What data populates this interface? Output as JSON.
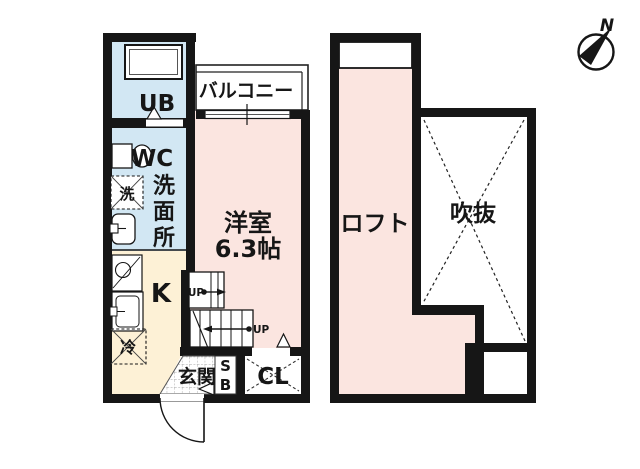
{
  "title": "apartment-floor-plan",
  "colors": {
    "wall": "#161616",
    "room_pink": "#fbe5e0",
    "room_blue": "#d2e7f3",
    "room_cream": "#fdf1d6",
    "white": "#ffffff",
    "thin_line": "#2a2a2a"
  },
  "compass": {
    "north": "N"
  },
  "floor1": {
    "balcony": "バルコニー",
    "unit_bath": "UB",
    "toilet": "WC",
    "washroom_chars": [
      "洗",
      "面",
      "所"
    ],
    "washer": "洗",
    "room_name": "洋室",
    "room_size": "6.3帖",
    "kitchen": "K",
    "fridge": "冷",
    "up": "UP",
    "entrance": "玄関",
    "shoebox_chars": [
      "S",
      "B"
    ],
    "closet": "CL"
  },
  "floor2": {
    "loft": "ロフト",
    "void": "吹抜"
  }
}
